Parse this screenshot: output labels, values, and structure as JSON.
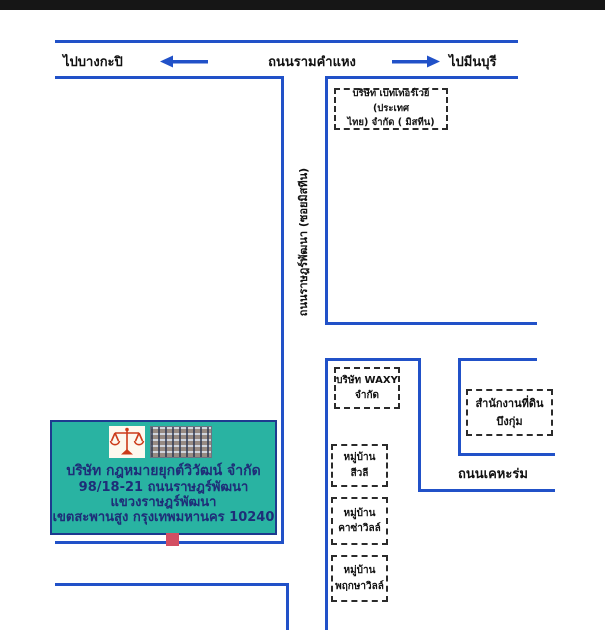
{
  "colors": {
    "road_blue": "#2151c8",
    "top_bar": "#161616",
    "card_teal": "#29b3a2",
    "card_border_navy": "#1e3a8f",
    "card_text_navy": "#1e2d78",
    "marker_pink": "#d34f63"
  },
  "roads": {
    "ramkhamhaeng": {
      "label": "ถนนรามคำแหง",
      "left_destination": "ไปบางกะปิ",
      "right_destination": "ไปมีนบุรี"
    },
    "ratphatthana": {
      "label": "ถนนราษฎร์พัฒนา (ซอยมิสทีน)"
    },
    "kheharom": {
      "label": "ถนนเคหะร่ม"
    }
  },
  "places": {
    "betterway": {
      "line1": "บริษัท เบทเทอร์เวย์ (ประเทศ",
      "line2": "ไทย) จำกัด  ( มิสทีน)"
    },
    "waxy": {
      "line1": "บริษัท WAXY",
      "line2": "จำกัด"
    },
    "land_office": {
      "line1": "สำนักงานที่ดิน",
      "line2": "บึงกุ่ม"
    },
    "villages": [
      {
        "line1": "หมู่บ้าน",
        "line2": "สีวลี"
      },
      {
        "line1": "หมู่บ้าน",
        "line2": "คาซ่าวิลล์"
      },
      {
        "line1": "หมู่บ้าน",
        "line2": "พฤกษาวิลล์"
      }
    ]
  },
  "company_card": {
    "name": "บริษัท กฎหมายยุกต์วิวัฒน์ จำกัด",
    "address_line1": "98/18-21 ถนนราษฎร์พัฒนา",
    "address_line2": "แขวงราษฎร์พัฒนา",
    "address_line3": "เขตสะพานสูง กรุงเทพมหานคร  10240"
  }
}
